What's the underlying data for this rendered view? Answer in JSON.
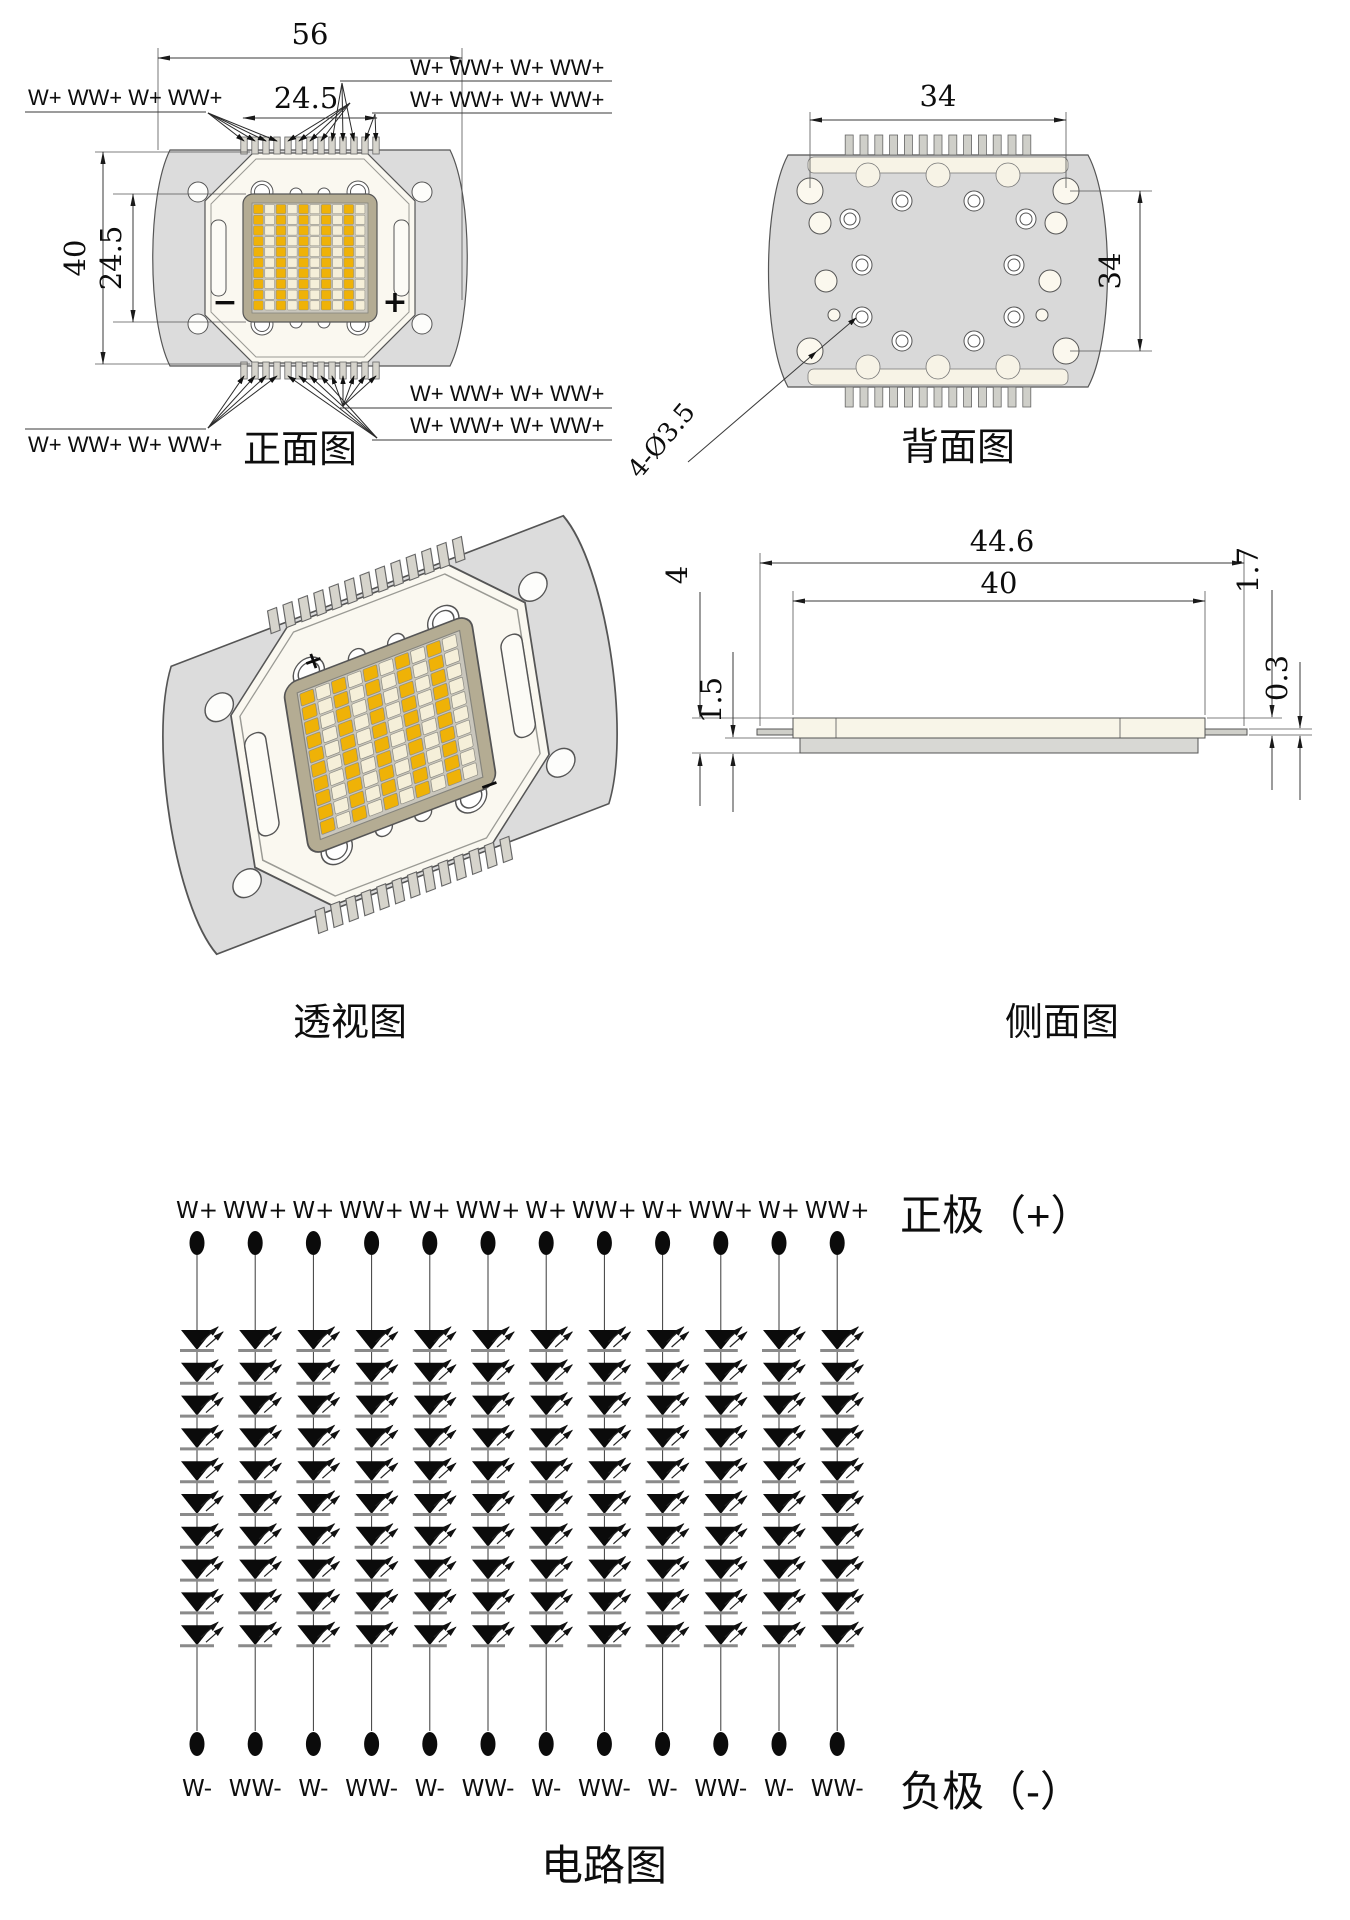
{
  "drawing": {
    "front": {
      "label": "正面图",
      "dim_width": "56",
      "dim_inner_width": "24.5",
      "dim_height": "40",
      "dim_inner_height": "24.5",
      "minus": "−",
      "plus": "+",
      "top_left_label": "W+ WW+ W+ WW+",
      "top_right_label_1": "W+ WW+ W+ WW+",
      "top_right_label_2": "W+ WW+ W+ WW+",
      "bottom_left_label": "W+ WW+ W+ WW+",
      "bottom_right_label_1": "W+ WW+ W+ WW+",
      "bottom_right_label_2": "W+ WW+ W+ WW+"
    },
    "back": {
      "label": "背面图",
      "dim_width": "34",
      "dim_height": "34",
      "hole_note": "4-Ø3.5"
    },
    "perspective": {
      "label": "透视图",
      "plus": "+",
      "minus": "−"
    },
    "side": {
      "label": "侧面图",
      "dim_overall": "44.6",
      "dim_body": "40",
      "dim_total_h": "4",
      "dim_top_h": "1.7",
      "dim_base_h": "1.5",
      "dim_pin_h": "0.3"
    }
  },
  "circuit": {
    "label": "电路图",
    "positive": "正极（+）",
    "negative": "负极（-）",
    "diodes_per_column": 10,
    "columns": [
      {
        "top": "W+",
        "bottom": "W-"
      },
      {
        "top": "WW+",
        "bottom": "WW-"
      },
      {
        "top": "W+",
        "bottom": "W-"
      },
      {
        "top": "WW+",
        "bottom": "WW-"
      },
      {
        "top": "W+",
        "bottom": "W-"
      },
      {
        "top": "WW+",
        "bottom": "WW-"
      },
      {
        "top": "W+",
        "bottom": "W-"
      },
      {
        "top": "WW+",
        "bottom": "WW-"
      },
      {
        "top": "W+",
        "bottom": "W-"
      },
      {
        "top": "WW+",
        "bottom": "WW-"
      },
      {
        "top": "W+",
        "bottom": "W-"
      },
      {
        "top": "WW+",
        "bottom": "WW-"
      }
    ]
  },
  "led_grid": {
    "rows": 10,
    "cols": 10,
    "warm_color": "#efb207",
    "white_color": "#f5efd9"
  },
  "colors": {
    "body_gray": "#dcdcdc",
    "plate": "#faf8f0",
    "frame": "#b4ac93",
    "grid_bg": "#c9c6bc",
    "pin": "#d6d4cc",
    "line": "#3a3a3a",
    "diode": "#0b0b0b"
  }
}
